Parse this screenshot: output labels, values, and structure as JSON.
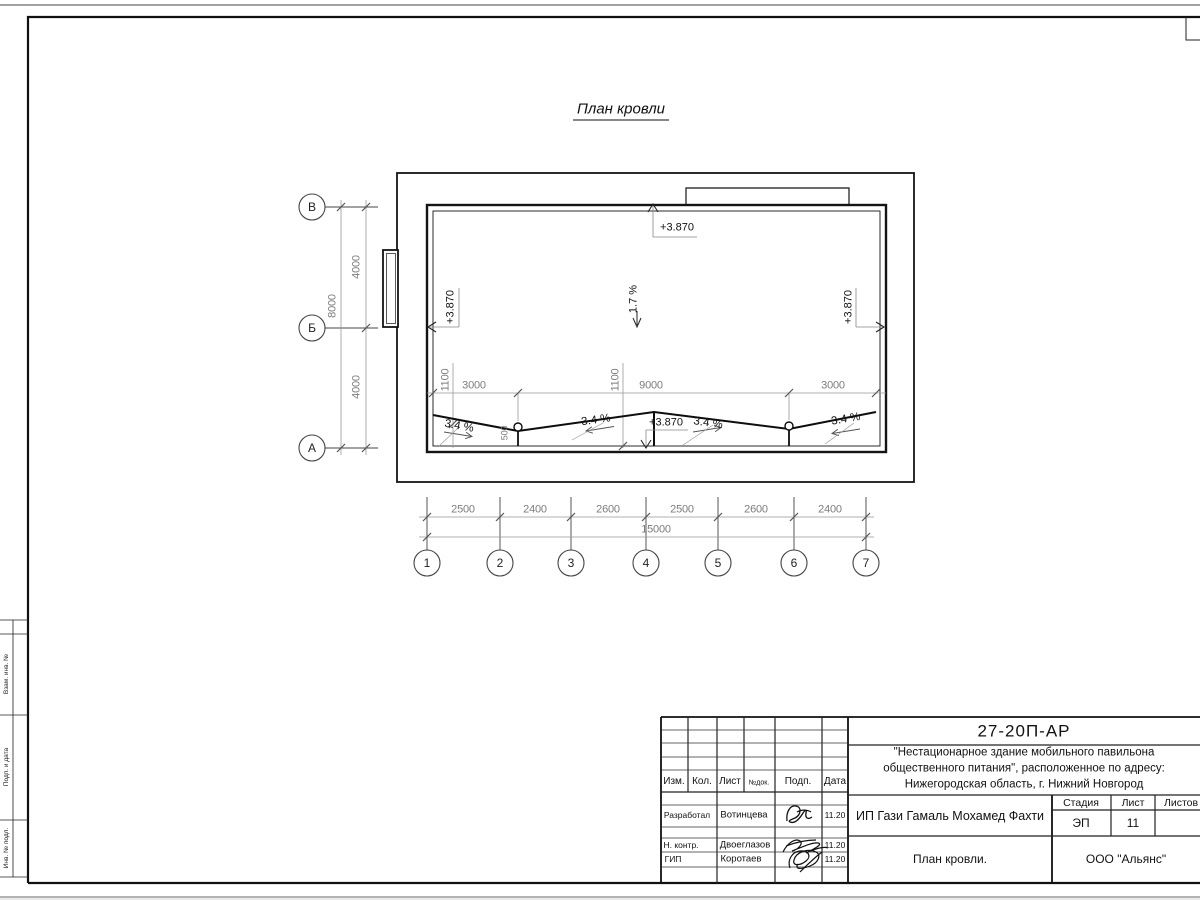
{
  "sheet": {
    "title": "План кровли",
    "left_margin_labels": [
      "Взам. инв. №",
      "Подп. и дата",
      "Инв. № подл."
    ]
  },
  "plan": {
    "axes_vertical": [
      "1",
      "2",
      "3",
      "4",
      "5",
      "6",
      "7"
    ],
    "axes_horizontal": [
      "В",
      "Б",
      "А"
    ],
    "dims_left": {
      "d1": "4000",
      "d2": "4000",
      "total": "8000"
    },
    "dims_bottom": {
      "segments": [
        "2500",
        "2400",
        "2600",
        "2500",
        "2600",
        "2400"
      ],
      "total": "15000"
    },
    "dims_inner": {
      "segments": [
        "3000",
        "9000",
        "3000"
      ],
      "offsets": [
        "1100",
        "1100"
      ],
      "funnel_offset": "500"
    },
    "elevation_marks": {
      "top": "+3.870",
      "left": "+3.870",
      "right": "+3.870",
      "bottom": "+3.870"
    },
    "slopes": {
      "main": "1.7 %",
      "drain": [
        "3.4 %",
        "3.4 %",
        "3.4 %",
        "3.4 %"
      ]
    }
  },
  "title_block": {
    "doc_number": "27-20П-АР",
    "description_line1": "\"Нестационарное здание мобильного павильона",
    "description_line2": "общественного питания\", расположенное по адресу:",
    "description_line3": "Нижегородская область, г. Нижний Новгород",
    "client": "ИП Гази Гамаль Мохамед Фахти",
    "sheet_title": "План кровли.",
    "organization": "ООО \"Альянс\"",
    "stage_label": "Стадия",
    "stage_value": "ЭП",
    "sheet_label": "Лист",
    "sheet_value": "11",
    "sheets_label": "Листов",
    "columns": [
      "Изм.",
      "Кол.",
      "Лист",
      "№док.",
      "Подп.",
      "Дата"
    ],
    "rows": [
      {
        "role": "Разработал",
        "name": "Вотинцева",
        "date": "11.20"
      },
      {
        "role": "Н. контр.",
        "name": "Двоеглазов",
        "date": "11.20"
      },
      {
        "role": "ГИП",
        "name": "Коротаев",
        "date": "11.20"
      }
    ]
  }
}
